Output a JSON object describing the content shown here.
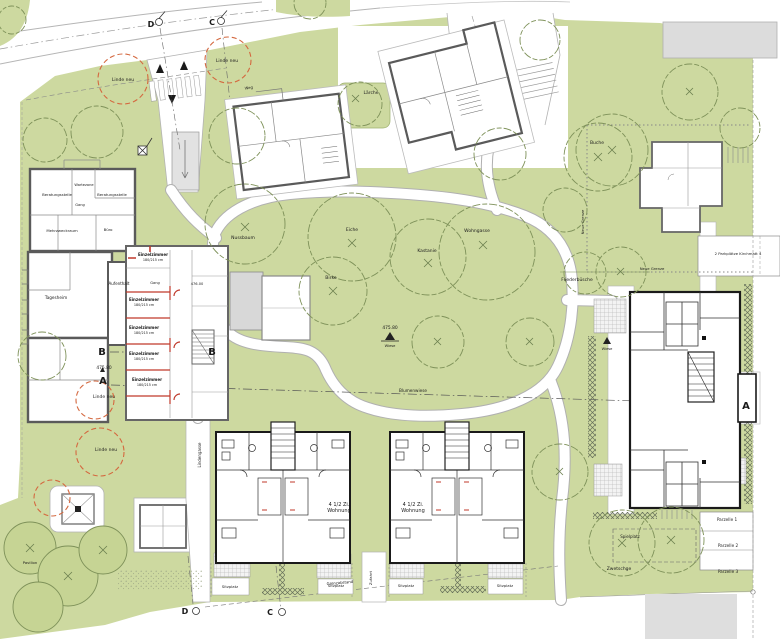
{
  "colors": {
    "lawn": "#cdd9a0",
    "lawn_dark": "#c6d494",
    "canopy": "#7e9159",
    "new_tree": "#d4683f",
    "red_walls": "#c0392b",
    "existing_wall": "#5a5a5a",
    "new_wall": "#1a1a1a"
  },
  "tree_labels": [
    {
      "t": "Nussbaum",
      "x": 243,
      "y": 239,
      "n": "tree-label-nussbaum"
    },
    {
      "t": "Eiche",
      "x": 352,
      "y": 231,
      "n": "tree-label-eiche"
    },
    {
      "t": "Birke",
      "x": 331,
      "y": 279,
      "n": "tree-label-birke"
    },
    {
      "t": "Kastanie",
      "x": 427,
      "y": 252,
      "n": "tree-label-kastanie"
    },
    {
      "t": "Wohngasse",
      "x": 477,
      "y": 232,
      "n": "label-wohngasse"
    },
    {
      "t": "Buche",
      "x": 597,
      "y": 144,
      "n": "tree-label-buche"
    },
    {
      "t": "Lärche",
      "x": 371,
      "y": 94,
      "n": "tree-label-laerche"
    },
    {
      "t": "Fliederbüsche",
      "x": 577,
      "y": 281,
      "n": "tree-label-fliederbuesche"
    },
    {
      "t": "Zwetschge",
      "x": 619,
      "y": 570,
      "n": "tree-label-zwetschge"
    }
  ],
  "new_tree_labels": [
    {
      "t": "Linde neu",
      "x": 123,
      "y": 81,
      "c": "#7a4a33",
      "n": "new-tree-label"
    },
    {
      "t": "Linde neu",
      "x": 227,
      "y": 62,
      "c": "#7a4a33",
      "n": "new-tree-label"
    },
    {
      "t": "Linde neu",
      "x": 104,
      "y": 398,
      "c": "#7a4a33",
      "n": "new-tree-label"
    },
    {
      "t": "Linde neu",
      "x": 106,
      "y": 451,
      "c": "#7a4a33",
      "n": "new-tree-label"
    }
  ],
  "room_labels": [
    {
      "t": "Beratungsstelle",
      "x": 57,
      "y": 196,
      "s": 3.8,
      "n": "room-label-beratungsstelle"
    },
    {
      "t": "Wartezone",
      "x": 84,
      "y": 186,
      "s": 3.6,
      "n": "room-label-wartezone"
    },
    {
      "t": "Beratungsstelle",
      "x": 112,
      "y": 196,
      "s": 3.8,
      "n": "room-label-beratungsstelle"
    },
    {
      "t": "Gang",
      "x": 80,
      "y": 206,
      "s": 3.6,
      "n": "room-label-gang"
    },
    {
      "t": "Mehrzweckraum",
      "x": 62,
      "y": 232,
      "s": 3.8,
      "n": "room-label-mehrzweckraum"
    },
    {
      "t": "Büro",
      "x": 108,
      "y": 231,
      "s": 3.8,
      "n": "room-label-buero"
    },
    {
      "t": "Tagesheim",
      "x": 56,
      "y": 299,
      "s": 4.2,
      "n": "room-label-tagesheim"
    },
    {
      "t": "Aufenthalt",
      "x": 119,
      "y": 285,
      "s": 4,
      "n": "room-label-aufenthalt"
    },
    {
      "t": "Gang",
      "x": 155,
      "y": 284,
      "s": 3.6,
      "n": "room-label-gang"
    }
  ],
  "residence_labels": [
    {
      "t": "Einzelzimmer",
      "x": 153,
      "y": 256,
      "b": 1,
      "s": 4,
      "n": "unit-label-einzelzimmer"
    },
    {
      "t": "180/215 cm",
      "x": 153,
      "y": 261,
      "s": 3.4,
      "n": "unit-label-dims"
    },
    {
      "t": "Einzelzimmer",
      "x": 144,
      "y": 301,
      "b": 1,
      "s": 4,
      "n": "unit-label-einzelzimmer"
    },
    {
      "t": "180/215 cm",
      "x": 144,
      "y": 306,
      "s": 3.4,
      "n": "unit-label-dims"
    },
    {
      "t": "Einzelzimmer",
      "x": 144,
      "y": 329,
      "b": 1,
      "s": 4,
      "n": "unit-label-einzelzimmer"
    },
    {
      "t": "180/215 cm",
      "x": 144,
      "y": 334,
      "s": 3.4,
      "n": "unit-label-dims"
    },
    {
      "t": "Einzelzimmer",
      "x": 144,
      "y": 355,
      "b": 1,
      "s": 4,
      "n": "unit-label-einzelzimmer"
    },
    {
      "t": "180/215 cm",
      "x": 144,
      "y": 360,
      "s": 3.4,
      "n": "unit-label-dims"
    },
    {
      "t": "Einzelzimmer",
      "x": 147,
      "y": 381,
      "b": 1,
      "s": 4,
      "n": "unit-label-einzelzimmer"
    },
    {
      "t": "180/215 cm",
      "x": 147,
      "y": 386,
      "s": 3.4,
      "n": "unit-label-dims"
    },
    {
      "t": "4 1/2 Zi.",
      "x": 339,
      "y": 506,
      "s": 5,
      "n": "unit-label-apartment"
    },
    {
      "t": "Wohnung",
      "x": 339,
      "y": 512,
      "s": 5,
      "n": "unit-label-apartment"
    },
    {
      "t": "4 1/2 Zi.",
      "x": 413,
      "y": 506,
      "s": 5,
      "n": "unit-label-apartment"
    },
    {
      "t": "Wohnung",
      "x": 413,
      "y": 512,
      "s": 5,
      "n": "unit-label-apartment"
    }
  ],
  "site_labels": [
    {
      "t": "Sitzplatz",
      "x": 230,
      "y": 588,
      "s": 3.8,
      "n": "label-sitzplatz"
    },
    {
      "t": "Sitzplatz",
      "x": 336,
      "y": 587,
      "s": 3.8,
      "n": "label-sitzplatz"
    },
    {
      "t": "Sitzplatz",
      "x": 406,
      "y": 587,
      "s": 3.8,
      "n": "label-sitzplatz"
    },
    {
      "t": "Sitzplatz",
      "x": 505,
      "y": 587,
      "s": 3.8,
      "n": "label-sitzplatz"
    },
    {
      "t": "Spielplatz",
      "x": 630,
      "y": 538,
      "s": 4,
      "n": "label-spielplatz"
    },
    {
      "t": "Parzelle 1",
      "x": 727,
      "y": 521,
      "s": 4.2,
      "n": "label-parzelle-1"
    },
    {
      "t": "Parzelle 2",
      "x": 728,
      "y": 547,
      "s": 4.2,
      "n": "label-parzelle-2"
    },
    {
      "t": "Parzelle 3",
      "x": 728,
      "y": 573,
      "s": 4.2,
      "n": "label-parzelle-3"
    },
    {
      "t": "2 Parkplätze Kirchmatt 4",
      "x": 738,
      "y": 255,
      "s": 3.8,
      "n": "label-parkplaetze"
    },
    {
      "t": "Neue Grenze",
      "x": 584,
      "y": 222,
      "s": 3.8,
      "r": -90,
      "n": "label-neue-grenze"
    },
    {
      "t": "Neue Grenze",
      "x": 652,
      "y": 270,
      "s": 3.8,
      "n": "label-neue-grenze"
    },
    {
      "t": "Blumenwiese",
      "x": 413,
      "y": 392,
      "s": 4.2,
      "n": "label-blumenwiese"
    },
    {
      "t": "Grenzabstand",
      "x": 340,
      "y": 584,
      "s": 3.8,
      "r": -5,
      "n": "label-grenzabstand"
    },
    {
      "t": "Lindengasse",
      "x": 201,
      "y": 455,
      "s": 4,
      "r": -90,
      "n": "label-lindengasse"
    },
    {
      "t": "Zufahrt",
      "x": 372,
      "y": 578,
      "s": 3.8,
      "r": -90,
      "n": "label-zufahrt"
    },
    {
      "t": "Weg",
      "x": 249,
      "y": 89,
      "s": 3.8,
      "r": -8,
      "n": "label-weg"
    },
    {
      "t": "Pavillon",
      "x": 30,
      "y": 564,
      "s": 3.8,
      "n": "label-pavillon"
    }
  ],
  "levels": [
    {
      "t": "475.80",
      "x": 104,
      "y": 369,
      "s": 4.4,
      "n": "level-mark"
    },
    {
      "t": "475.80",
      "x": 390,
      "y": 329,
      "s": 4.4,
      "n": "level-mark"
    },
    {
      "t": "Wiese",
      "x": 390,
      "y": 347,
      "s": 3.6,
      "n": "label-wiese"
    },
    {
      "t": "Wiese",
      "x": 607,
      "y": 350,
      "s": 3.6,
      "n": "label-wiese"
    },
    {
      "t": "476.00",
      "x": 197,
      "y": 285,
      "s": 3.6,
      "c": "#444444",
      "n": "level-mark"
    }
  ],
  "section_markers": [
    {
      "t": "A",
      "x": 103,
      "y": 384,
      "s": 10,
      "n": "section-marker-a"
    },
    {
      "t": "A",
      "x": 746,
      "y": 409,
      "s": 10,
      "n": "section-marker-a"
    },
    {
      "t": "B",
      "x": 102,
      "y": 355,
      "s": 10,
      "n": "section-marker-b"
    },
    {
      "t": "B",
      "x": 212,
      "y": 355,
      "s": 10,
      "n": "section-marker-b"
    },
    {
      "t": "D",
      "x": 151,
      "y": 27,
      "s": 8,
      "n": "section-marker-d"
    },
    {
      "t": "C",
      "x": 212,
      "y": 25,
      "s": 8,
      "n": "section-marker-c"
    },
    {
      "t": "D",
      "x": 185,
      "y": 614,
      "s": 8,
      "n": "section-marker-d"
    },
    {
      "t": "C",
      "x": 270,
      "y": 615,
      "s": 8,
      "n": "section-marker-c"
    }
  ]
}
